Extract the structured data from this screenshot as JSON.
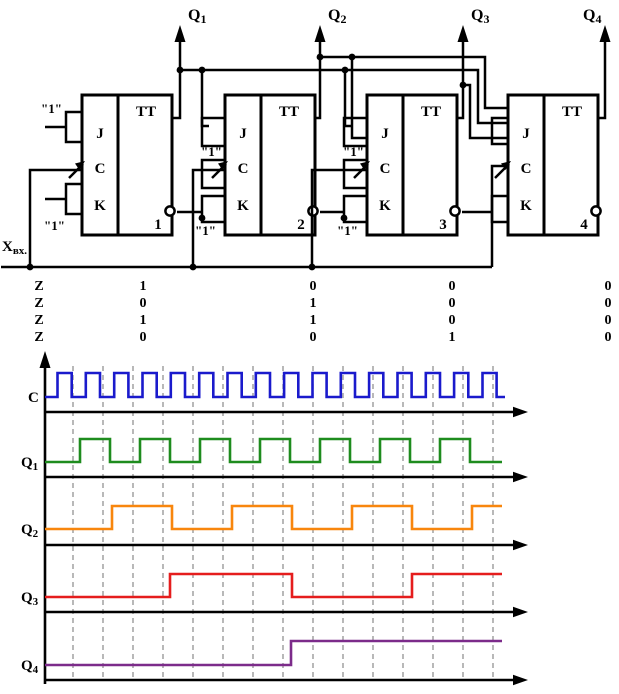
{
  "circuit": {
    "input_label": {
      "base": "X",
      "sub": "вх."
    },
    "logic_one_label": "\"1\"",
    "flip_flops": [
      {
        "number": "1",
        "type_label": "TT",
        "pin_j": "J",
        "pin_c": "C",
        "pin_k": "K"
      },
      {
        "number": "2",
        "type_label": "TT",
        "pin_j": "J",
        "pin_c": "C",
        "pin_k": "K"
      },
      {
        "number": "3",
        "type_label": "TT",
        "pin_j": "J",
        "pin_c": "C",
        "pin_k": "K"
      },
      {
        "number": "4",
        "type_label": "TT",
        "pin_j": "J",
        "pin_c": "C",
        "pin_k": "K"
      }
    ],
    "outputs": [
      {
        "base": "Q",
        "sub": "1"
      },
      {
        "base": "Q",
        "sub": "2"
      },
      {
        "base": "Q",
        "sub": "3"
      },
      {
        "base": "Q",
        "sub": "4"
      }
    ]
  },
  "table": {
    "rows": [
      [
        "Z",
        "1",
        "0",
        "0",
        "0"
      ],
      [
        "Z",
        "0",
        "1",
        "0",
        "0"
      ],
      [
        "Z",
        "1",
        "1",
        "0",
        "0"
      ],
      [
        "Z",
        "0",
        "0",
        "1",
        "0"
      ]
    ]
  },
  "chart_data": {
    "type": "digital-timing",
    "x_axis": {
      "start": 45,
      "end": 525,
      "n_clock_pulses": 16
    },
    "gridlines": {
      "first_x": 73,
      "spacing": 30,
      "count": 15
    },
    "signals": [
      {
        "label": {
          "base": "C",
          "sub": ""
        },
        "color": "#1a1acc",
        "initial_level": 0,
        "end_x": 505,
        "toggles_x": [
          57.5,
          71.7,
          85.8,
          100.0,
          114.2,
          128.4,
          142.5,
          156.7,
          170.8,
          185.0,
          199.2,
          213.3,
          227.5,
          241.7,
          255.8,
          270.0,
          284.1,
          298.3,
          312.5,
          326.6,
          340.8,
          355.0,
          369.1,
          383.3,
          397.5,
          411.6,
          425.8,
          440.0,
          454.1,
          468.3,
          482.5,
          496.6
        ]
      },
      {
        "label": {
          "base": "Q",
          "sub": "1"
        },
        "color": "#1e8c1e",
        "initial_level": 0,
        "end_x": 502,
        "toggles_x": [
          80,
          110,
          140,
          170,
          200,
          230,
          260,
          290,
          320,
          350,
          380,
          410,
          440,
          470
        ]
      },
      {
        "label": {
          "base": "Q",
          "sub": "2"
        },
        "color": "#f8860d",
        "initial_level": 0,
        "end_x": 502,
        "toggles_x": [
          112,
          172,
          232,
          292,
          352,
          412,
          472
        ]
      },
      {
        "label": {
          "base": "Q",
          "sub": "3"
        },
        "color": "#e51d1d",
        "initial_level": 0,
        "end_x": 502,
        "toggles_x": [
          170,
          292,
          412
        ]
      },
      {
        "label": {
          "base": "Q",
          "sub": "4"
        },
        "color": "#7c2b8a",
        "initial_level": 0,
        "end_x": 502,
        "toggles_x": [
          291
        ]
      }
    ]
  }
}
